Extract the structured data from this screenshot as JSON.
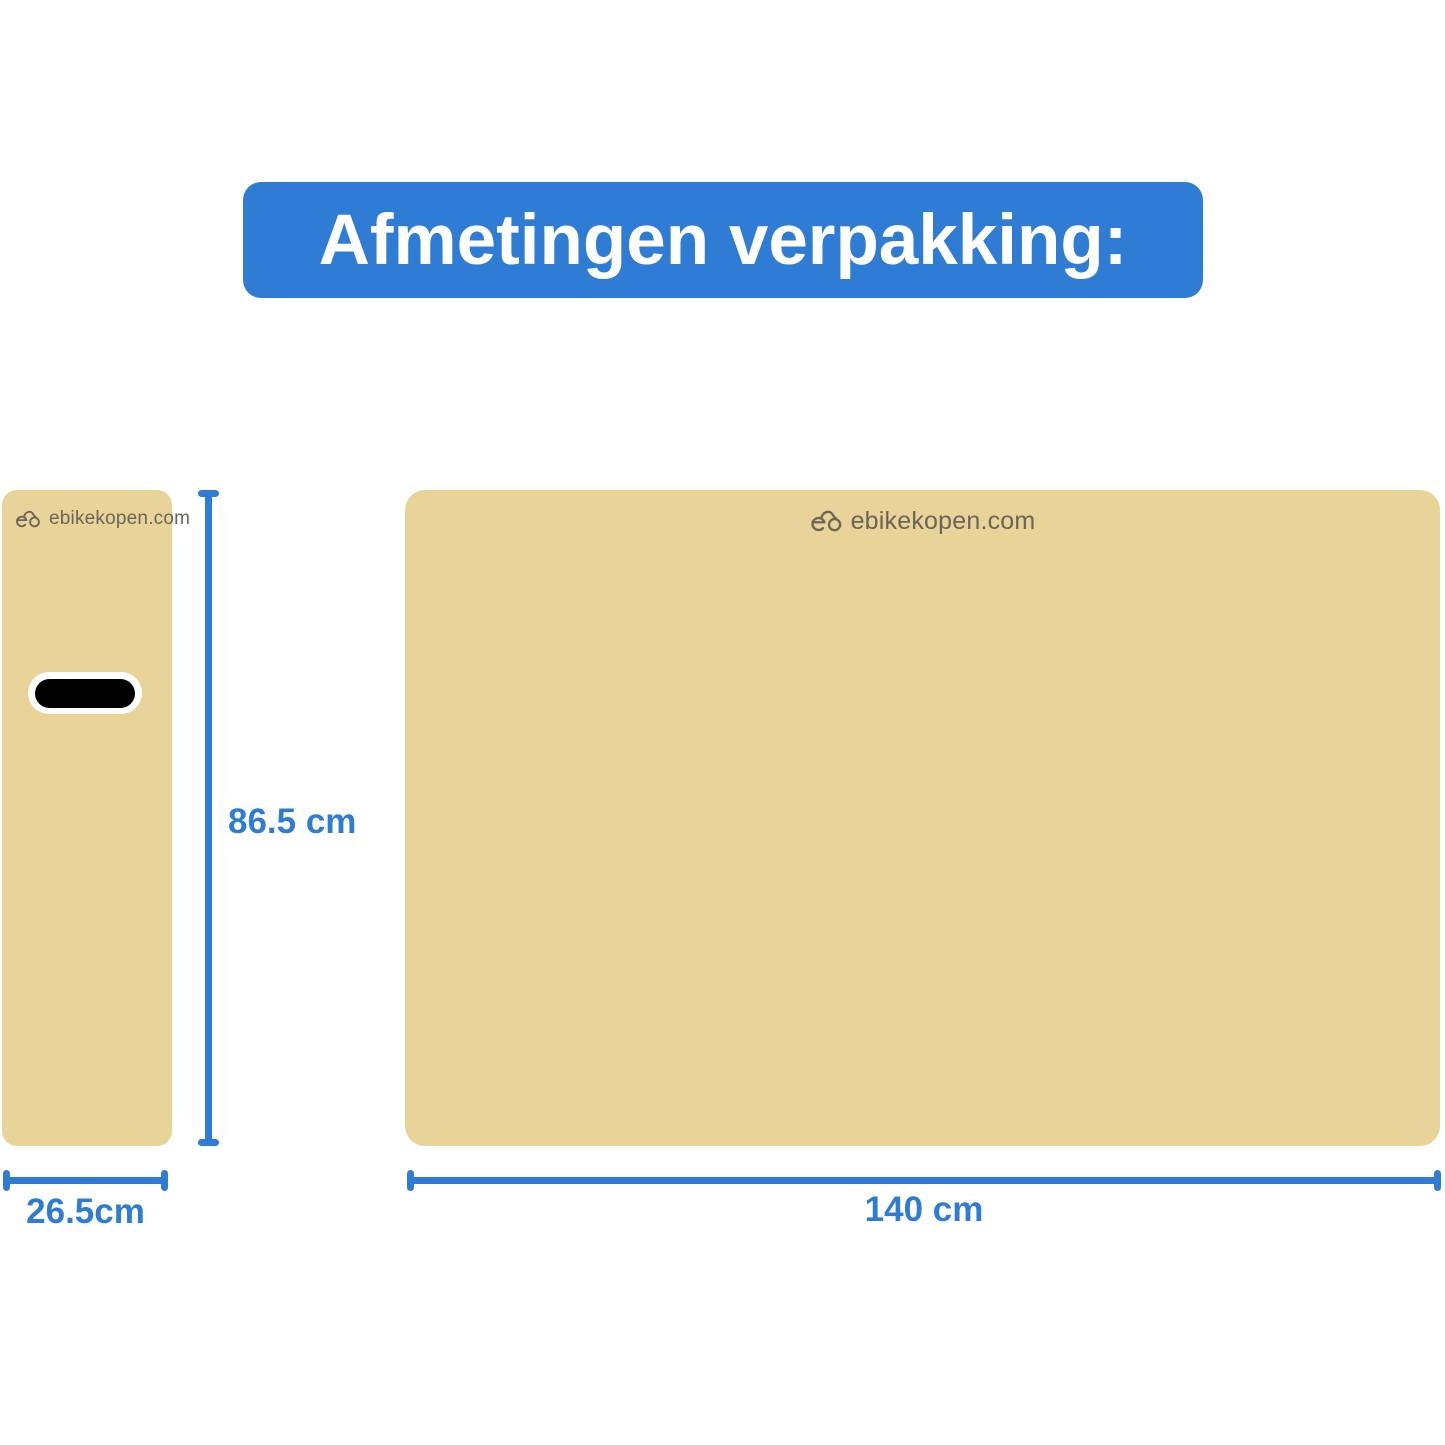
{
  "header": {
    "title": "Afmetingen verpakking:"
  },
  "brand": {
    "name": "ebikekopen.com",
    "icon": "ebike-logo-icon"
  },
  "boxes": {
    "side": {
      "brand": "ebikekopen.com"
    },
    "front": {
      "brand": "ebikekopen.com"
    }
  },
  "dimensions": {
    "height_label": "86.5 cm",
    "side_width_label": "26.5cm",
    "front_width_label": "140 cm"
  },
  "colors": {
    "accent": "#2f7cd4",
    "box-fill": "#e8d499",
    "logo-text": "#6b6557",
    "handle-fill": "#000000",
    "handle-outline": "#ffffff",
    "title-text": "#ffffff",
    "page-bg": "#ffffff"
  }
}
